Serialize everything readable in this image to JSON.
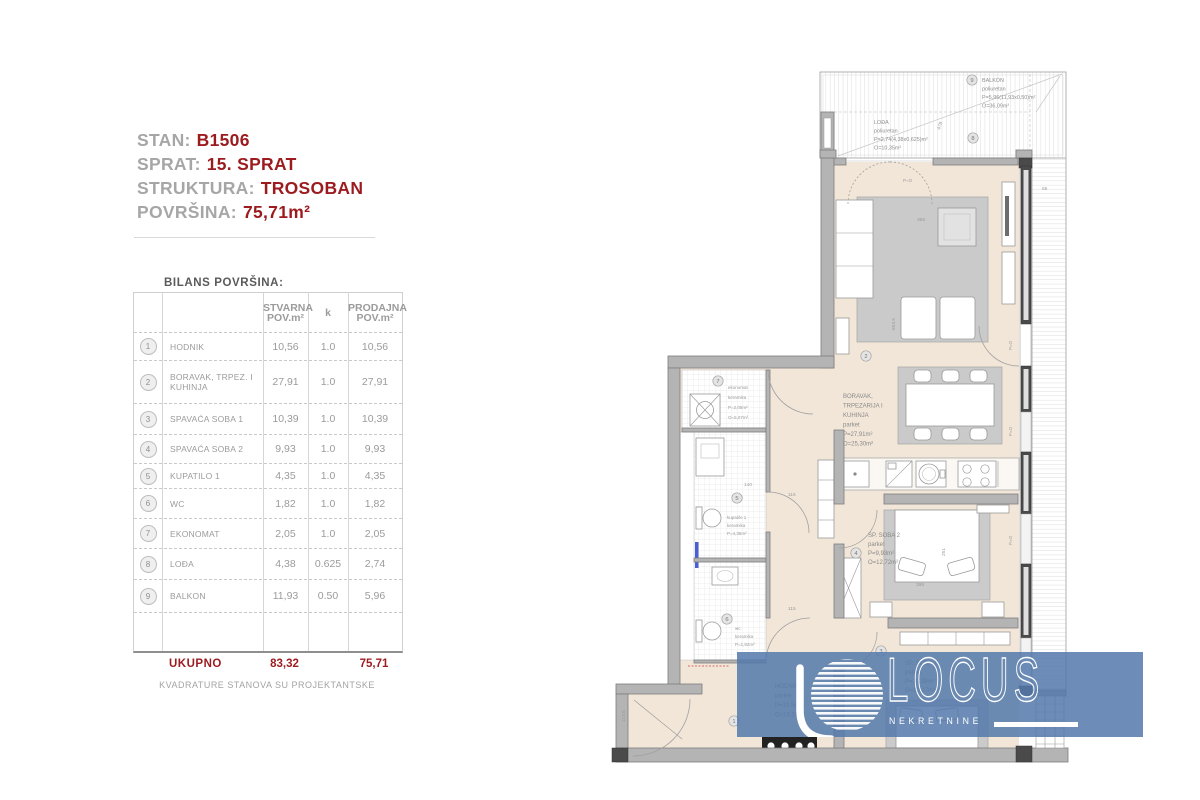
{
  "info": {
    "rows": [
      {
        "label": "STAN:",
        "value": "B1506"
      },
      {
        "label": "SPRAT:",
        "value": "15. SPRAT"
      },
      {
        "label": "STRUKTURA:",
        "value": "TROSOBAN"
      },
      {
        "label": "POVRŠINA:",
        "value": "75,71m²"
      }
    ]
  },
  "table": {
    "title": "BILANS POVRŠINA:",
    "headers": {
      "stvarna": [
        "STVARNA",
        "POV.m²"
      ],
      "k": "k",
      "prodajna": [
        "PRODAJNA",
        "POV.m²"
      ]
    },
    "rows": [
      {
        "num": "1",
        "name": "HODNIK",
        "stvarna": "10,56",
        "k": "1.0",
        "prodajna": "10,56"
      },
      {
        "num": "2",
        "name": "BORAVAK, TRPEZ. I KUHINJA",
        "stvarna": "27,91",
        "k": "1.0",
        "prodajna": "27,91"
      },
      {
        "num": "3",
        "name": "SPAVAĆA SOBA 1",
        "stvarna": "10,39",
        "k": "1.0",
        "prodajna": "10,39"
      },
      {
        "num": "4",
        "name": "SPAVAĆA SOBA 2",
        "stvarna": "9,93",
        "k": "1.0",
        "prodajna": "9,93"
      },
      {
        "num": "5",
        "name": "KUPATILO 1",
        "stvarna": "4,35",
        "k": "1.0",
        "prodajna": "4,35"
      },
      {
        "num": "6",
        "name": "WC",
        "stvarna": "1,82",
        "k": "1.0",
        "prodajna": "1,82"
      },
      {
        "num": "7",
        "name": "EKONOMAT",
        "stvarna": "2,05",
        "k": "1.0",
        "prodajna": "2,05"
      },
      {
        "num": "8",
        "name": "LOĐA",
        "stvarna": "4,38",
        "k": "0.625",
        "prodajna": "2,74"
      },
      {
        "num": "9",
        "name": "BALKON",
        "stvarna": "11,93",
        "k": "0.50",
        "prodajna": "5,96"
      }
    ],
    "total": {
      "label": "UKUPNO",
      "stvarna": "83,32",
      "prodajna": "75,71"
    },
    "footnote": "KVADRATURE STANOVA SU PROJEKTANTSKE"
  },
  "plan": {
    "balkon": {
      "num": "9",
      "lines": [
        "BALKON",
        "poliuretan",
        "P=5,96(11,93x0,50)m²",
        "O=36,09m²"
      ]
    },
    "lodja": {
      "num": "8",
      "lines": [
        "LOĐA",
        "poliuretan",
        "P=2,74(4,38x0,625)m²",
        "O=10,35m²"
      ]
    },
    "boravak": {
      "num": "2",
      "lines": [
        "BORAVAK,",
        "TRPEZARIJA I",
        "KUHINJA",
        "parket",
        "P=27,91m²",
        "O=25,30m²"
      ]
    },
    "soba2": {
      "num": "4",
      "lines": [
        "SP. SOBA 2",
        "parket",
        "P=9,93m²",
        "O=12,72m²"
      ]
    },
    "soba1": {
      "num": "3",
      "lines": [
        "SP. SOBA 1",
        "parket",
        "P=10,39m²",
        "O=13,17m²"
      ]
    },
    "hodnik": {
      "num": "1",
      "lines": [
        "HODNIK",
        "parket",
        "P=10,56m²",
        "O=13,30m²"
      ]
    },
    "ekonomat": {
      "num": "7",
      "lines": [
        "ekonomat",
        "keramika",
        "P=2,05m²",
        "O=5,07m²"
      ]
    },
    "kupatilo": {
      "num": "5",
      "lines": [
        "kupatilo 1",
        "keramika",
        "P=4,35m²"
      ]
    },
    "wc": {
      "num": "6",
      "lines": [
        "wc",
        "keramika",
        "P=1,82m²"
      ]
    },
    "po": "P=O",
    "dims": {
      "d478": "478",
      "d65": "65",
      "d115a": "115",
      "d115b": "115",
      "d368": "368",
      "d396": "396",
      "d251": "251",
      "d6535": "653.5",
      "d1135": "113.5",
      "d140": "140"
    }
  },
  "logo": {
    "title": "LOCUS",
    "subtitle": "NEKRETNINE"
  },
  "colors": {
    "accent": "#9c1b1f",
    "overlay": "#5578ac",
    "floor": "#f2e6d8"
  }
}
